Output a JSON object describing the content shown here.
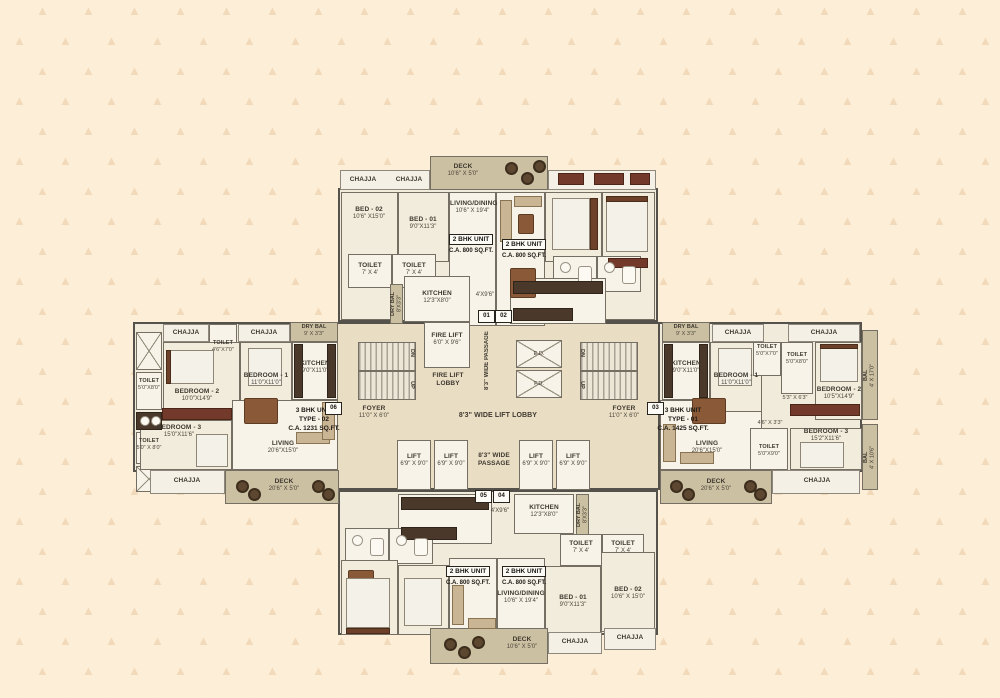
{
  "markers": {
    "m01": "01",
    "m02": "02",
    "m03": "03",
    "m04": "04",
    "m05": "05",
    "m06": "06"
  },
  "top_wing": {
    "deck": {
      "name": "DECK",
      "dims": "10'6\" X 5'0\""
    },
    "chajja": "CHAJJA",
    "bed02": {
      "name": "BED - 02",
      "dims": "10'6\" X15'0\""
    },
    "bed01": {
      "name": "BED - 01",
      "dims": "9'0\"X11'3\""
    },
    "living": {
      "name": "LIVING/DINING",
      "dims": "10'6\" X 19'4\""
    },
    "unit": {
      "line1": "2 BHK UNIT",
      "line2": "C.A. 800 SQ.FT."
    },
    "toilet": {
      "name": "TOILET",
      "dims": "7' X 4'"
    },
    "kitchen": {
      "name": "KITCHEN",
      "dims": "12'3\"X8'0\""
    },
    "dry_bal": {
      "name": "DRY BAL",
      "dims": "8'X3'3\""
    },
    "passage_dim": "4'X9'6\""
  },
  "bottom_wing": {
    "deck": {
      "name": "DECK",
      "dims": "10'6\" X 5'0\""
    },
    "chajja": "CHAJJA",
    "bed02": {
      "name": "BED - 02",
      "dims": "10'6\" X 15'0\""
    },
    "bed01": {
      "name": "BED - 01",
      "dims": "9'0\"X11'3\""
    },
    "living": {
      "name": "LIVING/DINING",
      "dims": "10'6\" X 19'4\""
    },
    "unit": {
      "line1": "2 BHK UNIT",
      "line2": "C.A. 800 SQ.FT."
    },
    "toilet": {
      "name": "TOILET",
      "dims": "7' X 4'"
    },
    "kitchen": {
      "name": "KITCHEN",
      "dims": "12'3\"X8'0\""
    },
    "dry_bal": {
      "name": "DRY BAL",
      "dims": "8'X3'3\""
    },
    "passage_dim": "4'X9'6\""
  },
  "left_wing": {
    "chajja": "CHAJJA",
    "dry_bal": {
      "name": "DRY BAL",
      "dims": "9' X 3'3\""
    },
    "toilet_top": {
      "name": "TOILET",
      "dims": "4'6\"X7'0\""
    },
    "toilet_side1": {
      "name": "TOILET",
      "dims": "5'0\"X8'0\""
    },
    "toilet_side2": {
      "name": "TOILET",
      "dims": "5'0\" X 8'0\""
    },
    "bedroom2": {
      "name": "BEDROOM - 2",
      "dims": "10'0\"X14'9\""
    },
    "bedroom1": {
      "name": "BEDROOM - 1",
      "dims": "11'0\"X11'0\""
    },
    "bedroom3": {
      "name": "BEDROOM - 3",
      "dims": "15'0\"X11'6\""
    },
    "kitchen": {
      "name": "KITCHEN",
      "dims": "9'0\"X11'0\""
    },
    "living": {
      "name": "LIVING",
      "dims": "20'6\"X15'0\""
    },
    "deck": {
      "name": "DECK",
      "dims": "20'6\" X 5'0\""
    },
    "unit": {
      "line1": "3 BHK UNIT",
      "line2": "TYPE - 02",
      "line3": "C.A. 1231 SQ.FT."
    }
  },
  "right_wing": {
    "chajja": "CHAJJA",
    "dry_bal": {
      "name": "DRY BAL",
      "dims": "9' X 3'3\""
    },
    "kitchen": {
      "name": "KITCHEN",
      "dims": "9'0\"X11'0\""
    },
    "bedroom1": {
      "name": "BEDROOM - 1",
      "dims": "11'0\"X11'0\""
    },
    "toilet1": {
      "name": "TOILET",
      "dims": "5'0\"X7'0\""
    },
    "toilet2": {
      "name": "TOILET",
      "dims": "5'0\"X8'0\""
    },
    "toilet3": {
      "name": "TOILET",
      "dims": "5'0\"X9'0\""
    },
    "bedroom2": {
      "name": "BEDROOM - 2",
      "dims": "10'5\"X14'9\""
    },
    "bedroom3": {
      "name": "BEDROOM - 3",
      "dims": "15'2\"X11'6\""
    },
    "bal_top": {
      "name": "BAL",
      "dims": "4' X 17'0\""
    },
    "bal_bottom": {
      "name": "BAL",
      "dims": "4' X 10'6\""
    },
    "pass1": "5'3\" X 6'3\"",
    "pass2": "4'6\" X 3'3\"",
    "living": {
      "name": "LIVING",
      "dims": "20'6\"X15'0\""
    },
    "deck": {
      "name": "DECK",
      "dims": "20'6\" X 5'0\""
    },
    "unit": {
      "line1": "3 BHK UNIT",
      "line2": "TYPE - 01",
      "line3": "C.A. 1425 SQ.FT."
    }
  },
  "core": {
    "fire_lift": {
      "name": "FIRE LIFT",
      "dims": "6'0\" X 9'6\""
    },
    "fire_lift_lobby": {
      "line1": "FIRE LIFT",
      "line2": "LOBBY"
    },
    "passage_top": "8'3\" WIDE PASSAGE",
    "lift_lobby": "8'3\" WIDE LIFT LOBBY",
    "foyer": {
      "name": "FOYER",
      "dims": "11'0\" X 6'0\""
    },
    "lift": {
      "name": "LIFT",
      "dims": "6'9\" X 9'0\""
    },
    "passage_bottom": {
      "line1": "8'3\" WIDE",
      "line2": "PASSAGE"
    },
    "shaft_top": "E.D.",
    "shaft_bottom": "F.D.",
    "up": "UP",
    "dn": "DN"
  }
}
